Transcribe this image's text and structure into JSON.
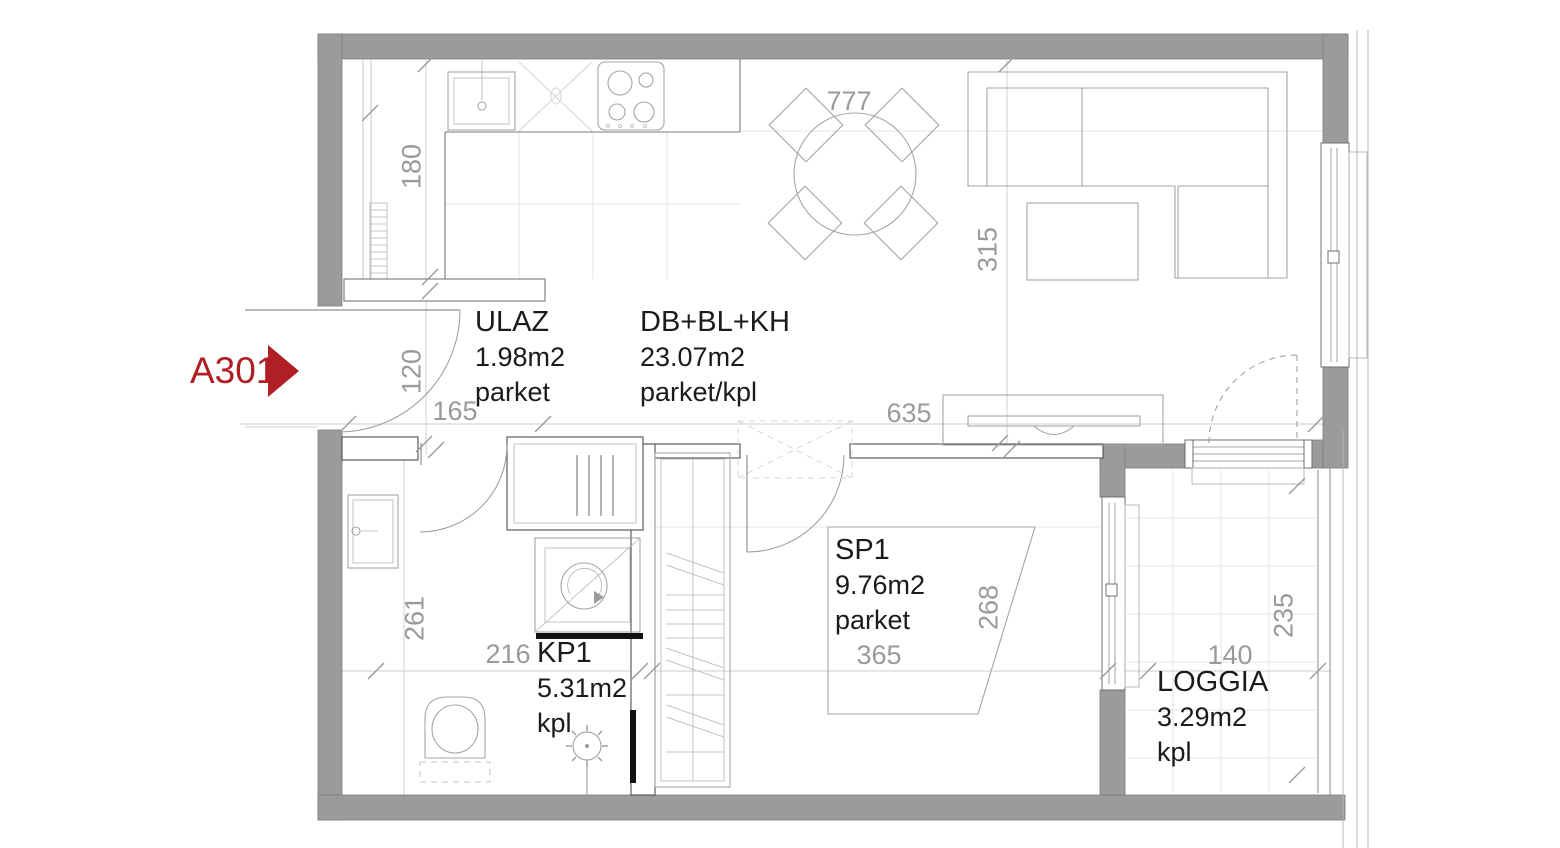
{
  "unit": {
    "label": "A301"
  },
  "colors": {
    "wall": "#9b9b9b",
    "accent": "#b01f24",
    "dim": "#9a9a9a",
    "text": "#1b1b1b"
  },
  "rooms": {
    "ulaz": {
      "name": "ULAZ",
      "area": "1.98m2",
      "floor": "parket"
    },
    "living": {
      "name": "DB+BL+KH",
      "area": "23.07m2",
      "floor": "parket/kpl"
    },
    "sp1": {
      "name": "SP1",
      "area": "9.76m2",
      "floor": "parket"
    },
    "kp1": {
      "name": "KP1",
      "area": "5.31m2",
      "floor": "kpl"
    },
    "loggia": {
      "name": "LOGGIA",
      "area": "3.29m2",
      "floor": "kpl"
    }
  },
  "dimensions": {
    "kitchen_depth": "180",
    "entry_width": "120",
    "entry_length": "165",
    "dining_width": "777",
    "living_depth": "315",
    "living_width": "635",
    "kp1_depth": "261",
    "kp1_width": "216",
    "sp1_width": "365",
    "sp1_depth": "268",
    "loggia_width": "140",
    "loggia_depth": "235"
  }
}
